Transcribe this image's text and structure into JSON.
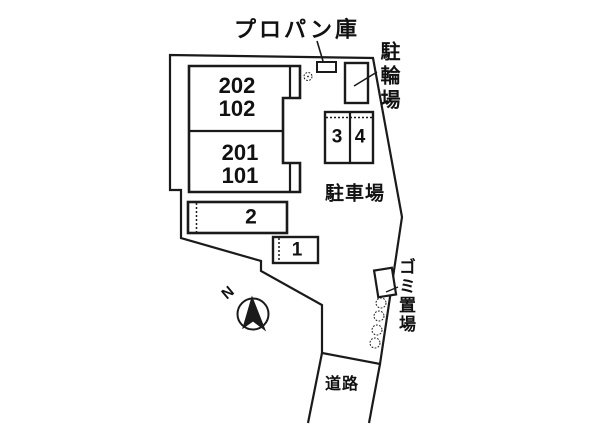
{
  "plan": {
    "labels": {
      "propane": "プロパン庫",
      "bicycle_parking": "駐輪場",
      "car_parking": "駐車場",
      "garbage": "ゴミ置場",
      "road": "道路",
      "north": "N"
    },
    "building": {
      "upper_room_lines": [
        "202",
        "102"
      ],
      "lower_room_lines": [
        "201",
        "101"
      ]
    },
    "parking_spaces": {
      "space1": "1",
      "space2": "2",
      "space3": "3",
      "space4": "4"
    },
    "colors": {
      "line": "#1a1a1a",
      "text": "#111111",
      "background": "#ffffff"
    }
  }
}
